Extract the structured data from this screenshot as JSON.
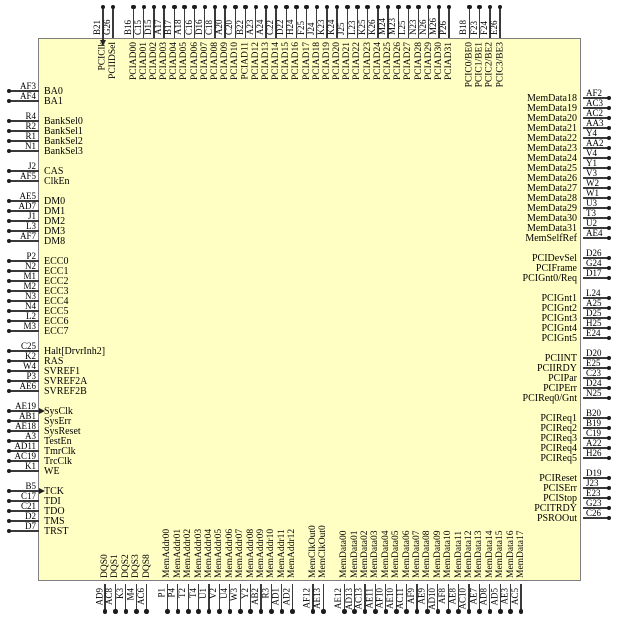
{
  "diagram": {
    "kind": "ic-pinout",
    "body_fill": "#FFFFC4",
    "body_border": "#7F7F7F",
    "pin_line_color": "#3A3A3A",
    "text_color": "#000000"
  },
  "sides": {
    "top": {
      "groups": [
        {
          "pins": [
            {
              "code": "B21",
              "name": "PCIClk",
              "clock": true
            },
            {
              "code": "G26",
              "name": "PCIIDSel"
            }
          ]
        },
        {
          "pins": [
            {
              "code": "B16",
              "name": "PCIAD00"
            },
            {
              "code": "C15",
              "name": "PCIAD01"
            },
            {
              "code": "D15",
              "name": "PCIAD02"
            },
            {
              "code": "A17",
              "name": "PCIAD03"
            },
            {
              "code": "B17",
              "name": "PCIAD04"
            },
            {
              "code": "A18",
              "name": "PCIAD05"
            },
            {
              "code": "C16",
              "name": "PCIAD06"
            },
            {
              "code": "D16",
              "name": "PCIAD07"
            },
            {
              "code": "C18",
              "name": "PCIAD08"
            },
            {
              "code": "A20",
              "name": "PCIAD09"
            },
            {
              "code": "C20",
              "name": "PCIAD10"
            },
            {
              "code": "B22",
              "name": "PCIAD11"
            },
            {
              "code": "A23",
              "name": "PCIAD12"
            },
            {
              "code": "A24",
              "name": "PCIAD13"
            },
            {
              "code": "C22",
              "name": "PCIAD14"
            },
            {
              "code": "D22",
              "name": "PCIAD15"
            },
            {
              "code": "H24",
              "name": "PCIAD16"
            },
            {
              "code": "F25",
              "name": "PCIAD17"
            },
            {
              "code": "J24",
              "name": "PCIAD18"
            },
            {
              "code": "K23",
              "name": "PCIAD19"
            },
            {
              "code": "K24",
              "name": "PCIAD20"
            },
            {
              "code": "J25",
              "name": "PCIAD21"
            },
            {
              "code": "L23",
              "name": "PCIAD22"
            },
            {
              "code": "K25",
              "name": "PCIAD23"
            },
            {
              "code": "K26",
              "name": "PCIAD24"
            },
            {
              "code": "M24",
              "name": "PCIAD25"
            },
            {
              "code": "M23",
              "name": "PCIAD26"
            },
            {
              "code": "L25",
              "name": "PCIAD27"
            },
            {
              "code": "N23",
              "name": "PCIAD28"
            },
            {
              "code": "N26",
              "name": "PCIAD29"
            },
            {
              "code": "M26",
              "name": "PCIAD30"
            },
            {
              "code": "P26",
              "name": "PCIAD31"
            }
          ]
        },
        {
          "pins": [
            {
              "code": "B18",
              "name": "PCIC0/BE0"
            },
            {
              "code": "F23",
              "name": "PCIC1/BE1"
            },
            {
              "code": "F24",
              "name": "PCIC2/BE2"
            },
            {
              "code": "E26",
              "name": "PCIC3/BE3"
            }
          ]
        }
      ]
    },
    "left": {
      "groups": [
        {
          "pins": [
            {
              "code": "AF3",
              "name": "BA0"
            },
            {
              "code": "AF4",
              "name": "BA1"
            }
          ]
        },
        {
          "pins": [
            {
              "code": "R4",
              "name": "BankSel0"
            },
            {
              "code": "R2",
              "name": "BankSel1"
            },
            {
              "code": "R1",
              "name": "BankSel2"
            },
            {
              "code": "N1",
              "name": "BankSel3"
            }
          ]
        },
        {
          "pins": [
            {
              "code": "J2",
              "name": "CAS"
            },
            {
              "code": "AF5",
              "name": "ClkEn"
            }
          ]
        },
        {
          "pins": [
            {
              "code": "AE5",
              "name": "DM0"
            },
            {
              "code": "AD7",
              "name": "DM1"
            },
            {
              "code": "J1",
              "name": "DM2"
            },
            {
              "code": "L3",
              "name": "DM3"
            },
            {
              "code": "AF7",
              "name": "DM8"
            }
          ]
        },
        {
          "pins": [
            {
              "code": "P2",
              "name": "ECC0"
            },
            {
              "code": "N2",
              "name": "ECC1"
            },
            {
              "code": "M1",
              "name": "ECC2"
            },
            {
              "code": "M2",
              "name": "ECC3"
            },
            {
              "code": "N3",
              "name": "ECC4"
            },
            {
              "code": "N4",
              "name": "ECC5"
            },
            {
              "code": "L2",
              "name": "ECC6"
            },
            {
              "code": "M3",
              "name": "ECC7"
            }
          ]
        },
        {
          "pins": [
            {
              "code": "C25",
              "name": "Halt[DrvrInh2]"
            },
            {
              "code": "K2",
              "name": "RAS"
            },
            {
              "code": "W4",
              "name": "SVREF1"
            },
            {
              "code": "P3",
              "name": "SVREF2A"
            },
            {
              "code": "AE6",
              "name": "SVREF2B"
            }
          ]
        },
        {
          "pins": [
            {
              "code": "AE19",
              "name": "SysClk",
              "clock": true
            },
            {
              "code": "AB1",
              "name": "SysErr"
            },
            {
              "code": "AE18",
              "name": "SysReset"
            },
            {
              "code": "A3",
              "name": "TestEn"
            },
            {
              "code": "AD11",
              "name": "TmrClk"
            },
            {
              "code": "AC19",
              "name": "TrcClk"
            },
            {
              "code": "K1",
              "name": "WE"
            }
          ]
        },
        {
          "pins": [
            {
              "code": "B5",
              "name": "TCK",
              "clock": true
            },
            {
              "code": "C17",
              "name": "TDI"
            },
            {
              "code": "C21",
              "name": "TDO"
            },
            {
              "code": "D2",
              "name": "TMS"
            },
            {
              "code": "D7",
              "name": "TRST"
            }
          ]
        }
      ]
    },
    "right": {
      "groups": [
        {
          "pins": [
            {
              "code": "AF2",
              "name": "MemData18"
            },
            {
              "code": "AC3",
              "name": "MemData19"
            },
            {
              "code": "AC2",
              "name": "MemData20"
            },
            {
              "code": "AA3",
              "name": "MemData21"
            },
            {
              "code": "Y4",
              "name": "MemData22"
            },
            {
              "code": "AA2",
              "name": "MemData23"
            },
            {
              "code": "V4",
              "name": "MemData24"
            },
            {
              "code": "Y1",
              "name": "MemData25"
            },
            {
              "code": "V3",
              "name": "MemData26"
            },
            {
              "code": "W2",
              "name": "MemData27"
            },
            {
              "code": "W1",
              "name": "MemData28"
            },
            {
              "code": "U3",
              "name": "MemData29"
            },
            {
              "code": "T3",
              "name": "MemData30"
            },
            {
              "code": "U2",
              "name": "MemData31"
            },
            {
              "code": "AE4",
              "name": "MemSelfRef"
            }
          ]
        },
        {
          "pins": [
            {
              "code": "D26",
              "name": "PCIDevSel"
            },
            {
              "code": "G24",
              "name": "PCIFrame"
            },
            {
              "code": "D17",
              "name": "PCIGnt0/Req"
            }
          ]
        },
        {
          "pins": [
            {
              "code": "L24",
              "name": "PCIGnt1"
            },
            {
              "code": "A25",
              "name": "PCIGnt2"
            },
            {
              "code": "D25",
              "name": "PCIGnt3"
            },
            {
              "code": "H25",
              "name": "PCIGnt4"
            },
            {
              "code": "E24",
              "name": "PCIGnt5"
            }
          ]
        },
        {
          "pins": [
            {
              "code": "D20",
              "name": "PCIINT"
            },
            {
              "code": "E25",
              "name": "PCIIRDY"
            },
            {
              "code": "C23",
              "name": "PCIPar"
            },
            {
              "code": "D24",
              "name": "PCIPErr"
            },
            {
              "code": "N25",
              "name": "PCIReq0/Gnt"
            }
          ]
        },
        {
          "pins": [
            {
              "code": "B20",
              "name": "PCIReq1"
            },
            {
              "code": "B19",
              "name": "PCIReq2"
            },
            {
              "code": "C19",
              "name": "PCIReq3"
            },
            {
              "code": "A22",
              "name": "PCIReq4"
            },
            {
              "code": "H26",
              "name": "PCIReq5"
            }
          ]
        },
        {
          "pins": [
            {
              "code": "D19",
              "name": "PCIReset"
            },
            {
              "code": "J23",
              "name": "PCISErr"
            },
            {
              "code": "E23",
              "name": "PCIStop"
            },
            {
              "code": "G23",
              "name": "PCITRDY"
            },
            {
              "code": "C26",
              "name": "PSROOut"
            }
          ]
        }
      ]
    },
    "bottom": {
      "groups": [
        {
          "pins": [
            {
              "code": "AD9",
              "name": "DQS0"
            },
            {
              "code": "AC8",
              "name": "DQS1"
            },
            {
              "code": "K3",
              "name": "DQS2"
            },
            {
              "code": "M4",
              "name": "DQS3"
            },
            {
              "code": "AC6",
              "name": "DQS8"
            }
          ]
        },
        {
          "pins": [
            {
              "code": "P1",
              "name": "MemAddr00"
            },
            {
              "code": "P4",
              "name": "MemAddr01"
            },
            {
              "code": "T2",
              "name": "MemAddr02"
            },
            {
              "code": "T4",
              "name": "MemAddr03"
            },
            {
              "code": "U1",
              "name": "MemAddr04"
            },
            {
              "code": "V2",
              "name": "MemAddr05"
            },
            {
              "code": "U4",
              "name": "MemAddr06"
            },
            {
              "code": "W3",
              "name": "MemAddr07"
            },
            {
              "code": "Y2",
              "name": "MemAddr08"
            },
            {
              "code": "AB2",
              "name": "MemAddr09"
            },
            {
              "code": "R3",
              "name": "MemAddr10"
            },
            {
              "code": "AD1",
              "name": "MemAddr11"
            },
            {
              "code": "AD2",
              "name": "MemAddr12"
            }
          ]
        },
        {
          "pins": [
            {
              "code": "AF12",
              "name": "MemClkOut0"
            },
            {
              "code": "AE13",
              "name": "MemClkOut0"
            }
          ]
        },
        {
          "pins": [
            {
              "code": "AE12",
              "name": "MemData00"
            },
            {
              "code": "AD13",
              "name": "MemData01"
            },
            {
              "code": "AC13",
              "name": "MemData02"
            },
            {
              "code": "AE11",
              "name": "MemData03"
            },
            {
              "code": "AF10",
              "name": "MemData04"
            },
            {
              "code": "AE10",
              "name": "MemData05"
            },
            {
              "code": "AC11",
              "name": "MemData06"
            },
            {
              "code": "AF9",
              "name": "MemData07"
            },
            {
              "code": "AE9",
              "name": "MemData08"
            },
            {
              "code": "AD10",
              "name": "MemData09"
            },
            {
              "code": "AF8",
              "name": "MemData10"
            },
            {
              "code": "AE8",
              "name": "MemData11"
            },
            {
              "code": "AC10",
              "name": "MemData12"
            },
            {
              "code": "AE7",
              "name": "MemData13"
            },
            {
              "code": "AD8",
              "name": "MemData14"
            },
            {
              "code": "AD5",
              "name": "MemData15"
            },
            {
              "code": "AE3",
              "name": "MemData16"
            },
            {
              "code": "AC5",
              "name": "MemData17"
            }
          ]
        }
      ]
    }
  }
}
